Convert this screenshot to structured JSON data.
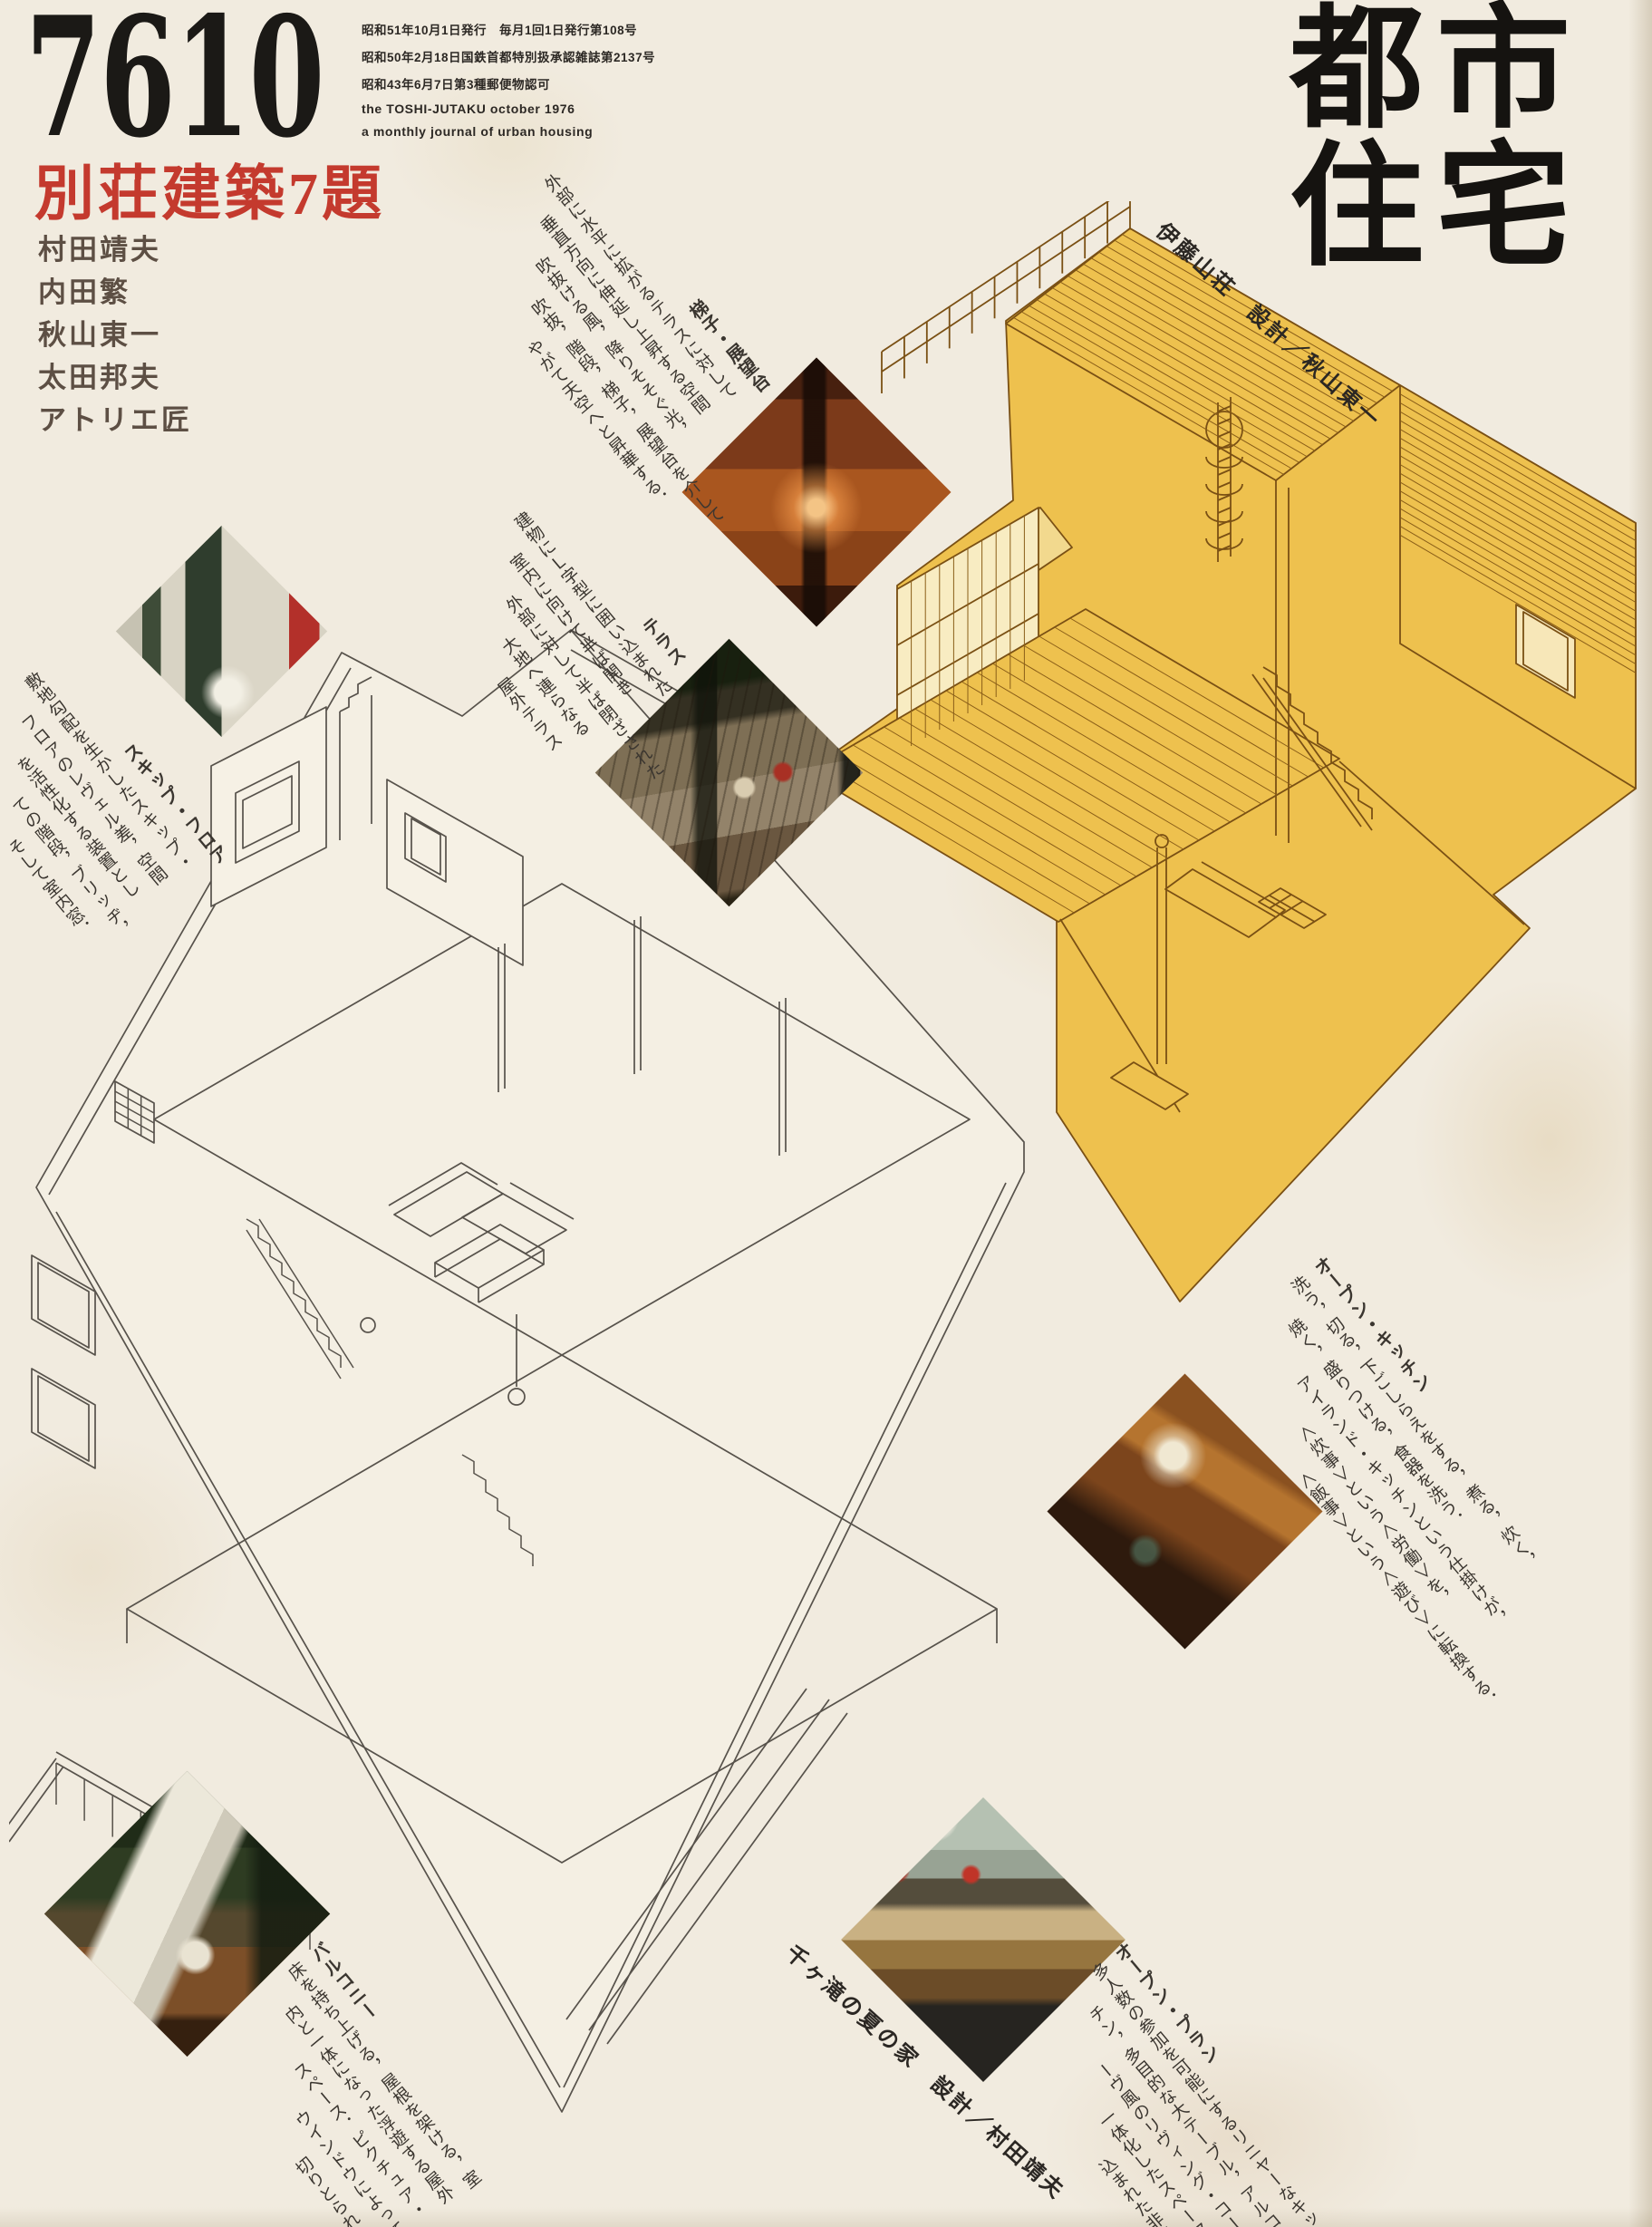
{
  "header": {
    "issue_number": "7610",
    "feature_title": "別荘建築7題",
    "authors": [
      "村田靖夫",
      "内田繁",
      "秋山東一",
      "太田邦夫",
      "アトリエ匠"
    ],
    "masthead": [
      "都市",
      "住宅"
    ],
    "publication_info": [
      "昭和51年10月1日発行　毎月1回1日発行第108号",
      "昭和50年2月18日国鉄首都特別扱承認雑誌第2137号",
      "昭和43年6月7日第3種郵便物認可",
      "the TOSHI-JUTAKU october 1976",
      "a monthly journal of urban housing"
    ]
  },
  "captions": {
    "ito_sanso": "伊藤山荘　設計／秋山東一",
    "chigataki": "千ヶ滝の夏の家　設計／村田靖夫"
  },
  "blocks": {
    "hashigo": {
      "title": "梯子・展望台",
      "lines": [
        "外部に水平に拡がるテラスに対して",
        "垂直方向に伸延し上昇する空間",
        "吹抜ける風，降りそそぐ光，",
        "吹抜，階段，梯子，展望台を介して",
        "やがて天空へと昇華する．"
      ]
    },
    "terrace": {
      "title": "テラス",
      "lines": [
        "建物にＬ字型に囲い込まれた",
        "室内に向けて半ば開き",
        "外部に対して半ば閉ざされた",
        "大地へ連らなる",
        "屋外テラス"
      ]
    },
    "skip_floor": {
      "title": "スキップ・フロア",
      "lines": [
        "敷地勾配を生かしたスキップ・",
        "フロアのレヴェル差，空間",
        "を活性化する装置とし",
        "ての階段，ブリッヂ，",
        "そして室内窓．"
      ]
    },
    "open_kitchen": {
      "title": "オープン・キッチン",
      "lines": [
        "洗う，切る，下ごしらえをする，煮る，炊く，",
        "焼く，盛りつける，食器を洗う．",
        "アイランド・キッチンという仕掛けが，",
        "＜炊事＞という＜労働＞を，",
        "＜飯事＞という＜遊び＞に転換する．"
      ]
    },
    "balcony": {
      "title": "バルコニー",
      "lines": [
        "床を持ち上げる，屋根を架ける，室",
        "内と一体になった浮遊する屋外",
        "スペース．ピクチュア・",
        "ウインドウによって",
        "切りとられた緑．"
      ]
    },
    "open_plan": {
      "title": "オープン・プラン",
      "lines": [
        "多人数の参加を可能にするリニヤーなキッ",
        "チン，多目的な大テーブル，アルコ",
        "ーヴ風のリヴィング・コーナー．",
        "一体化したスペースに封じ",
        "込まれた非日常性．"
      ]
    }
  },
  "colors": {
    "paper": "#f1ebdf",
    "accent_red": "#c43a2e",
    "house_yellow": "#eec14e",
    "drawing_brown": "#7a5014",
    "drawing_gray": "#57524b",
    "ink": "#2e2a26"
  }
}
